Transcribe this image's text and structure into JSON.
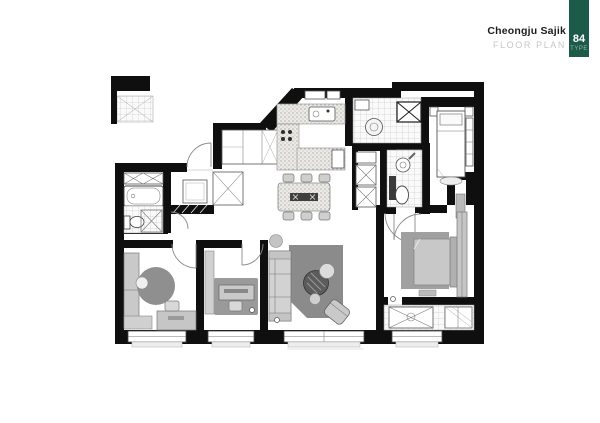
{
  "header": {
    "project_name": "Cheongju Sajik",
    "subtitle": "FLOOR PLAN",
    "badge": {
      "number": "84",
      "label": "TYPE"
    }
  },
  "colors": {
    "badge_background": "#1d5b49",
    "badge_label_text": "#8fb3a6",
    "badge_number_text": "#ffffff",
    "project_name_text": "#1c1c1c",
    "subtitle_text": "#c6c6c6",
    "wall_black": "#0f0f0f",
    "rug_gray": "#8b8b8b",
    "round_rug_gray": "#8f8f8f",
    "bedroom_rug_gray": "#9a9a9a",
    "master_rug_gray": "#a0a0a0",
    "furniture_light_gray": "#c9c9c9",
    "coffee_table_dark": "#5c5c5c",
    "background": "#ffffff"
  }
}
